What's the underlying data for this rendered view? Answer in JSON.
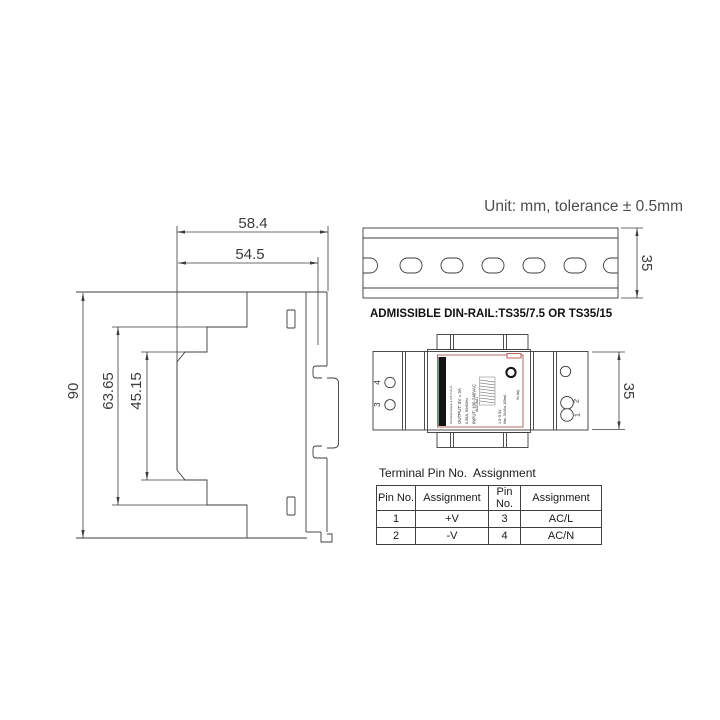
{
  "note": "Unit: mm, tolerance ± 0.5mm",
  "side_view": {
    "dim_total_depth": "58.4",
    "dim_body_depth": "54.5",
    "dim_total_height": "90",
    "dim_mid_height": "63.65",
    "dim_inner_height": "45.15"
  },
  "din_rail": {
    "dim_height": "35",
    "caption": "ADMISSIBLE DIN-RAIL:TS35/7.5 OR TS35/15"
  },
  "unit_view": {
    "dim_height": "35",
    "terminal_labels_left": [
      "4",
      "3"
    ],
    "terminal_labels_right": [
      "2",
      "1"
    ],
    "label": {
      "torque": "Terminal torque 4.4-5.3 Lb-in",
      "output": "OUTPUT: 5V = 3A",
      "input_current": "0.55A, 50/60Hz",
      "input": "INPUT: 100-240VAC",
      "adjust_range": "4.5~5.5V",
      "load_range": "Max. 3A Min. 100mA",
      "vo_adj": "Vo Adj.",
      "brand": "MEAN WELL"
    }
  },
  "pin_table": {
    "title": "Terminal Pin No.  Assignment",
    "headers": [
      "Pin No.",
      "Assignment",
      "Pin No.",
      "Assignment"
    ],
    "rows": [
      [
        "1",
        "+V",
        "3",
        "AC/L"
      ],
      [
        "2",
        "-V",
        "4",
        "AC/N"
      ]
    ]
  }
}
